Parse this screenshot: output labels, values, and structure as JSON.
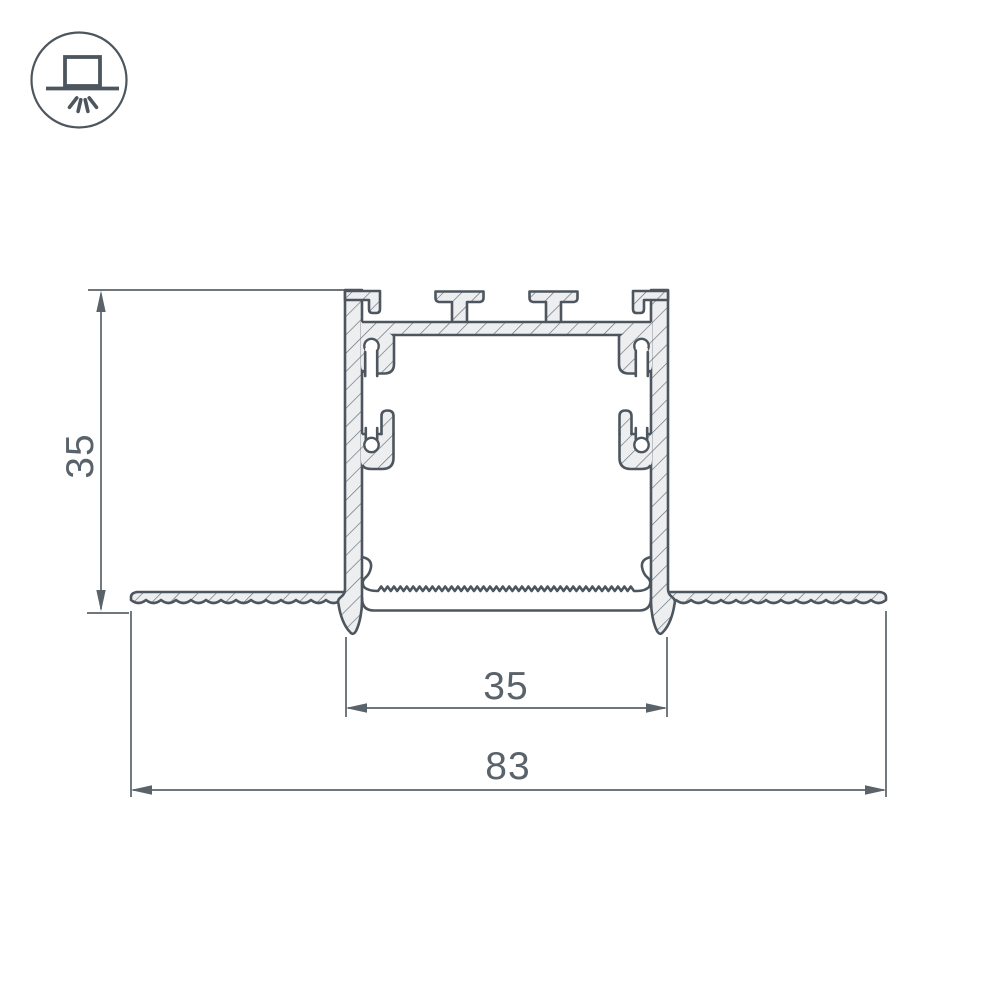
{
  "page": {
    "background_color": "#ffffff"
  },
  "header_icon": {
    "name": "recessed-mount-light-icon"
  },
  "drawing": {
    "type": "technical-cross-section",
    "dimension_labels": {
      "profile_height": "35",
      "inner_width": "35",
      "overall_width": "83"
    },
    "colors": {
      "outline": "#4d565e",
      "material_fill": "#edeef0",
      "dimension_lines": "#5a626a",
      "hatch": "#5f686f"
    }
  }
}
